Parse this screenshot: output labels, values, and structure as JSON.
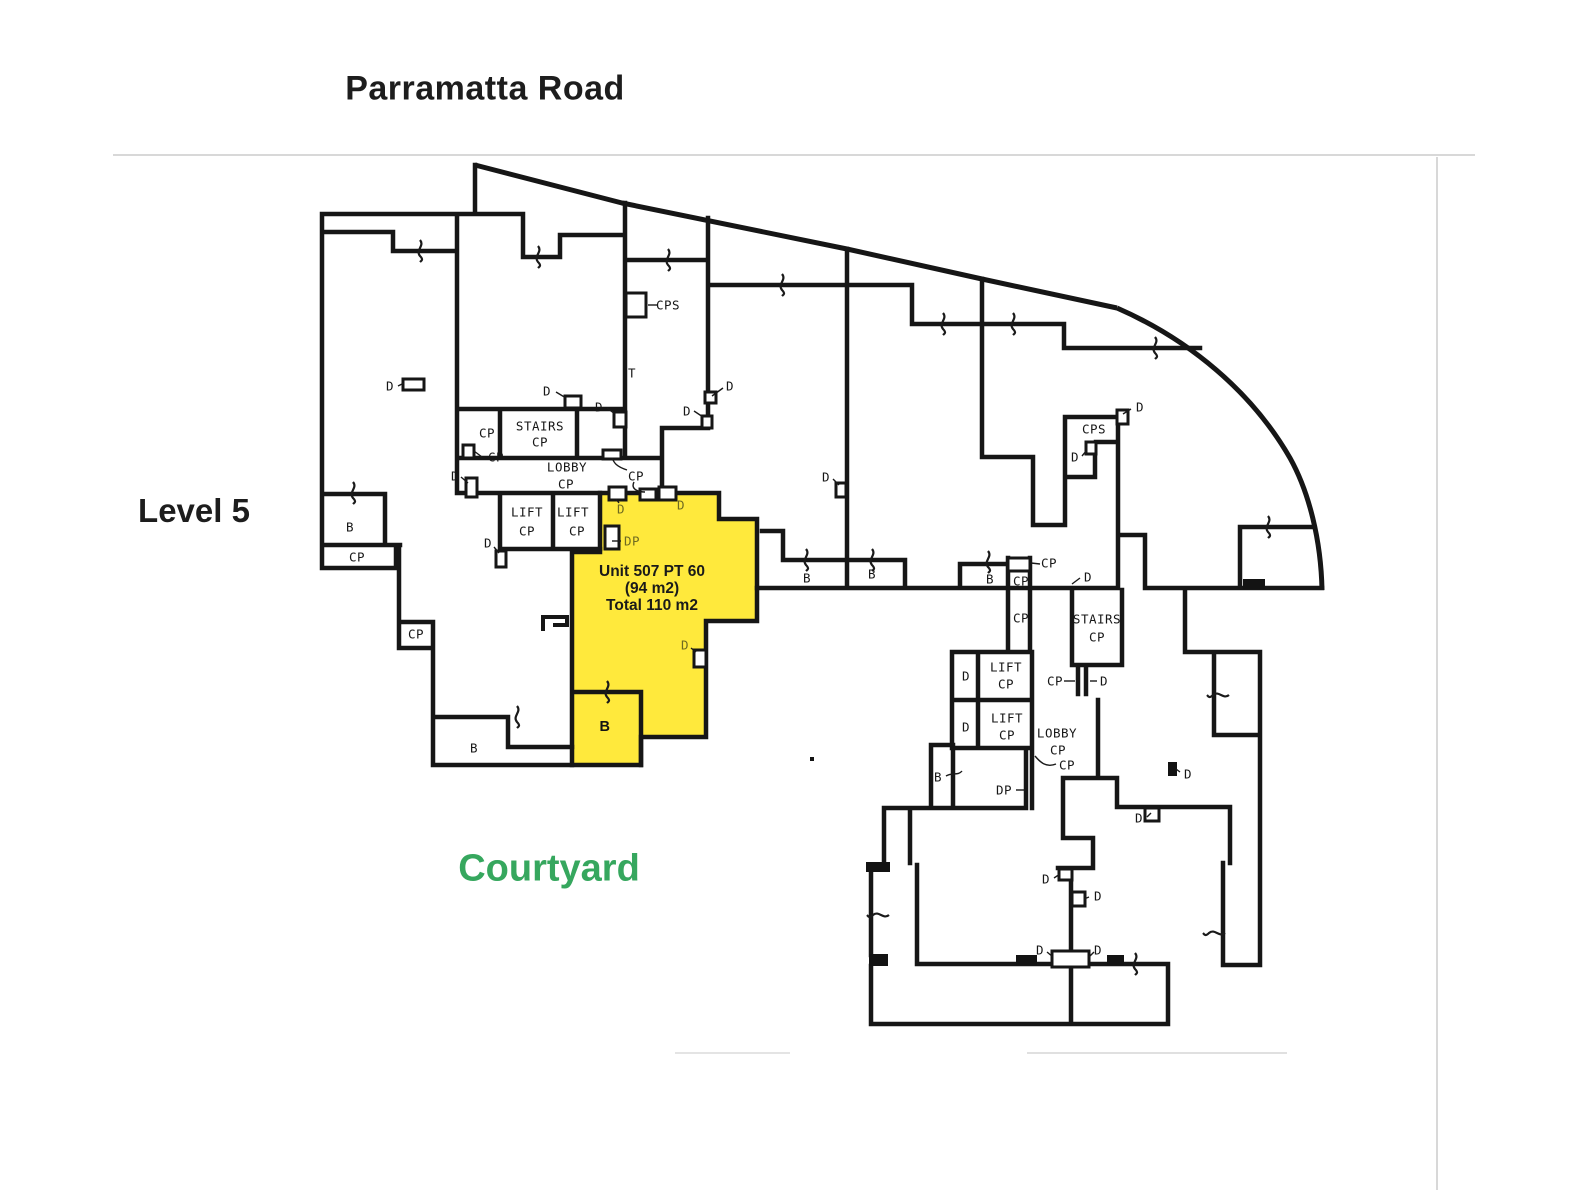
{
  "header": {
    "road_label": "Parramatta Road",
    "level_label": "Level 5",
    "courtyard_label": "Courtyard"
  },
  "highlighted_unit": {
    "name": "Unit 507 PT 60",
    "area": "(94 m2)",
    "total": "Total 110 m2",
    "fill": "#ffe93c"
  },
  "colors": {
    "wall": "#161616",
    "courtyard_green": "#36a75e",
    "unit_door_label_olive": "#6e6a20",
    "faint_line": "#d8d8d8"
  },
  "plan": {
    "labels": [
      {
        "t": "B",
        "x": 350,
        "y": 527,
        "s": ""
      },
      {
        "t": "CP",
        "x": 357,
        "y": 557,
        "s": ""
      },
      {
        "t": "CP",
        "x": 416,
        "y": 634,
        "s": ""
      },
      {
        "t": "B",
        "x": 474,
        "y": 748,
        "s": ""
      },
      {
        "t": "D",
        "x": 390,
        "y": 386,
        "s": ""
      },
      {
        "t": "D",
        "x": 455,
        "y": 476,
        "s": ""
      },
      {
        "t": "CP",
        "x": 487,
        "y": 433,
        "s": ""
      },
      {
        "t": "CP",
        "x": 496,
        "y": 457,
        "s": ""
      },
      {
        "t": "STAIRS",
        "x": 540,
        "y": 426,
        "s": ""
      },
      {
        "t": "CP",
        "x": 540,
        "y": 442,
        "s": ""
      },
      {
        "t": "LOBBY",
        "x": 567,
        "y": 467,
        "s": ""
      },
      {
        "t": "CP",
        "x": 566,
        "y": 484,
        "s": ""
      },
      {
        "t": "LIFT",
        "x": 527,
        "y": 512,
        "s": ""
      },
      {
        "t": "CP",
        "x": 527,
        "y": 531,
        "s": ""
      },
      {
        "t": "LIFT",
        "x": 573,
        "y": 512,
        "s": ""
      },
      {
        "t": "CP",
        "x": 577,
        "y": 531,
        "s": ""
      },
      {
        "t": "D",
        "x": 488,
        "y": 543,
        "s": ""
      },
      {
        "t": "D",
        "x": 547,
        "y": 391,
        "s": ""
      },
      {
        "t": "D",
        "x": 599,
        "y": 407,
        "s": ""
      },
      {
        "t": "CPS",
        "x": 668,
        "y": 305,
        "s": ""
      },
      {
        "t": "T",
        "x": 632,
        "y": 373,
        "s": ""
      },
      {
        "t": "D",
        "x": 687,
        "y": 411,
        "s": ""
      },
      {
        "t": "D",
        "x": 730,
        "y": 386,
        "s": ""
      },
      {
        "t": "CP",
        "x": 636,
        "y": 476,
        "s": ""
      },
      {
        "t": "D",
        "x": 826,
        "y": 477,
        "s": ""
      },
      {
        "t": "B",
        "x": 807,
        "y": 578,
        "s": ""
      },
      {
        "t": "B",
        "x": 872,
        "y": 574,
        "s": ""
      },
      {
        "t": "B",
        "x": 990,
        "y": 579,
        "s": ""
      },
      {
        "t": "CP",
        "x": 1049,
        "y": 563,
        "s": ""
      },
      {
        "t": "CP",
        "x": 1021,
        "y": 581,
        "s": ""
      },
      {
        "t": "CP",
        "x": 1021,
        "y": 618,
        "s": ""
      },
      {
        "t": "D",
        "x": 1088,
        "y": 577,
        "s": ""
      },
      {
        "t": "STAIRS",
        "x": 1097,
        "y": 619,
        "s": ""
      },
      {
        "t": "CP",
        "x": 1097,
        "y": 637,
        "s": ""
      },
      {
        "t": "D",
        "x": 966,
        "y": 676,
        "s": ""
      },
      {
        "t": "LIFT",
        "x": 1006,
        "y": 667,
        "s": ""
      },
      {
        "t": "CP",
        "x": 1006,
        "y": 684,
        "s": ""
      },
      {
        "t": "CP",
        "x": 1055,
        "y": 681,
        "s": ""
      },
      {
        "t": "D",
        "x": 1104,
        "y": 681,
        "s": ""
      },
      {
        "t": "D",
        "x": 966,
        "y": 727,
        "s": ""
      },
      {
        "t": "LIFT",
        "x": 1007,
        "y": 718,
        "s": ""
      },
      {
        "t": "CP",
        "x": 1007,
        "y": 735,
        "s": ""
      },
      {
        "t": "LOBBY",
        "x": 1057,
        "y": 733,
        "s": ""
      },
      {
        "t": "CP",
        "x": 1058,
        "y": 750,
        "s": ""
      },
      {
        "t": "CP",
        "x": 1067,
        "y": 765,
        "s": ""
      },
      {
        "t": "B",
        "x": 938,
        "y": 777,
        "s": ""
      },
      {
        "t": "DP",
        "x": 1004,
        "y": 790,
        "s": ""
      },
      {
        "t": "D",
        "x": 1046,
        "y": 879,
        "s": ""
      },
      {
        "t": "D",
        "x": 1098,
        "y": 896,
        "s": ""
      },
      {
        "t": "D",
        "x": 1188,
        "y": 774,
        "s": ""
      },
      {
        "t": "D",
        "x": 1139,
        "y": 818,
        "s": ""
      },
      {
        "t": "D",
        "x": 1040,
        "y": 950,
        "s": ""
      },
      {
        "t": "D",
        "x": 1098,
        "y": 950,
        "s": ""
      },
      {
        "t": "CPS",
        "x": 1094,
        "y": 429,
        "s": ""
      },
      {
        "t": "D",
        "x": 1140,
        "y": 407,
        "s": ""
      },
      {
        "t": "D",
        "x": 1075,
        "y": 457,
        "s": ""
      },
      {
        "t": "D",
        "x": 621,
        "y": 509,
        "s": "olive"
      },
      {
        "t": "D",
        "x": 681,
        "y": 505,
        "s": "olive"
      },
      {
        "t": "DP",
        "x": 632,
        "y": 541,
        "s": "olive"
      },
      {
        "t": "D",
        "x": 685,
        "y": 645,
        "s": "olive"
      },
      {
        "t": "B",
        "x": 605,
        "y": 727,
        "s": "bbold"
      }
    ]
  }
}
